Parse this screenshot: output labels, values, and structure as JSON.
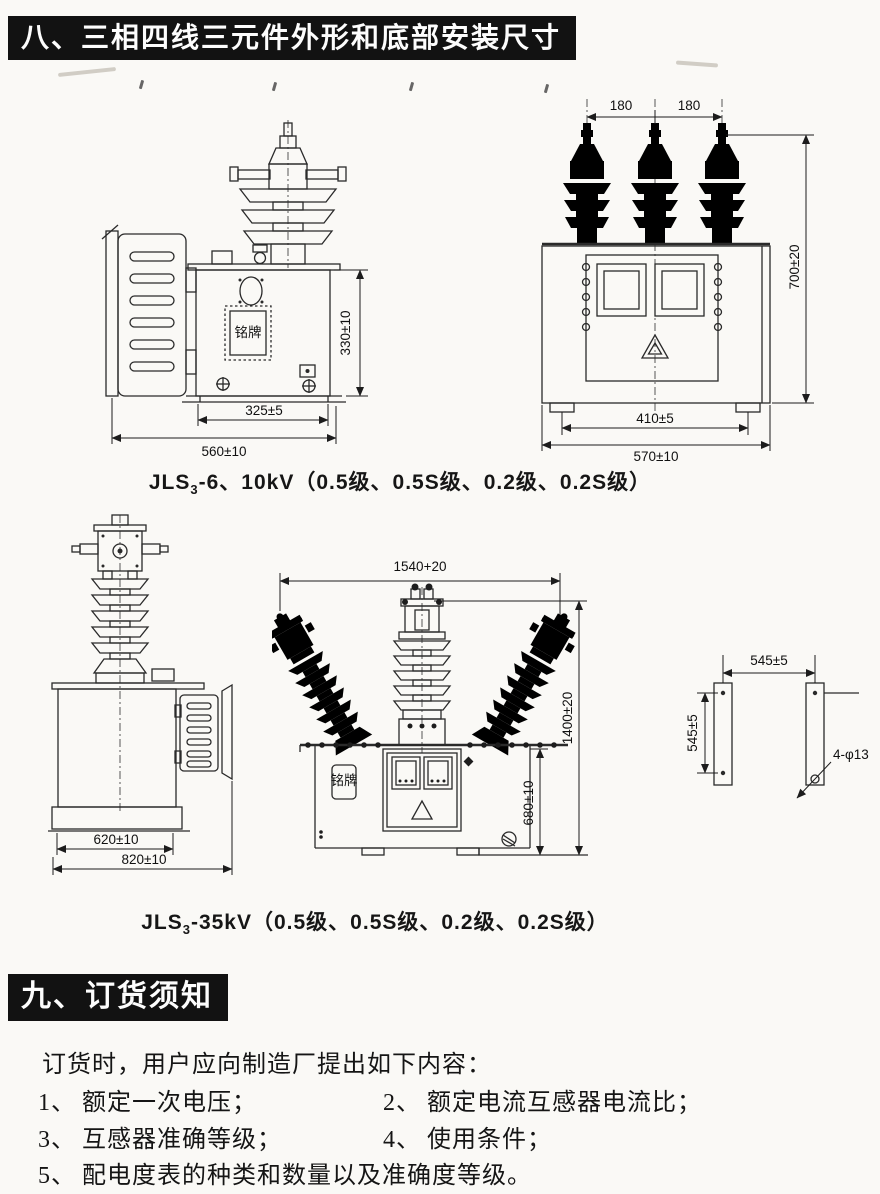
{
  "sections": {
    "s8": {
      "title": "八、三相四线三元件外形和底部安装尺寸"
    },
    "s9": {
      "title": "九、订货须知"
    }
  },
  "fig10kv": {
    "caption": {
      "model": "JLS",
      "sub": "3",
      "rest": "-6、10kV（0.5级、0.5S级、0.2级、0.2S级）"
    },
    "side": {
      "nameplate": "铭牌",
      "dim_height": "330±10",
      "dim_base": "325±5",
      "dim_overall": "560±10"
    },
    "front": {
      "dim_left": "180",
      "dim_right": "180",
      "dim_height": "700±20",
      "dim_base": "410±5",
      "dim_overall": "570±10"
    }
  },
  "fig35kv": {
    "caption": {
      "model": "JLS",
      "sub": "3",
      "rest": "-35kV（0.5级、0.5S级、0.2级、0.2S级）"
    },
    "side": {
      "dim_base": "620±10",
      "dim_overall": "820±10"
    },
    "front": {
      "nameplate": "铭牌",
      "dim_width": "1540+20",
      "dim_height": "1400±20",
      "dim_tank": "680±10"
    },
    "footprint": {
      "dim_spacing": "545±5",
      "dim_length": "545±5",
      "dim_holes": "4-φ13"
    }
  },
  "ordering": {
    "intro": "订货时，用户应向制造厂提出如下内容：",
    "items": [
      {
        "num": "1、",
        "text": "额定一次电压；"
      },
      {
        "num": "2、",
        "text": "额定电流互感器电流比；"
      },
      {
        "num": "3、",
        "text": "互感器准确等级；"
      },
      {
        "num": "4、",
        "text": "使用条件；"
      },
      {
        "num": "5、",
        "text": "配电度表的种类和数量以及准确度等级。"
      }
    ]
  }
}
